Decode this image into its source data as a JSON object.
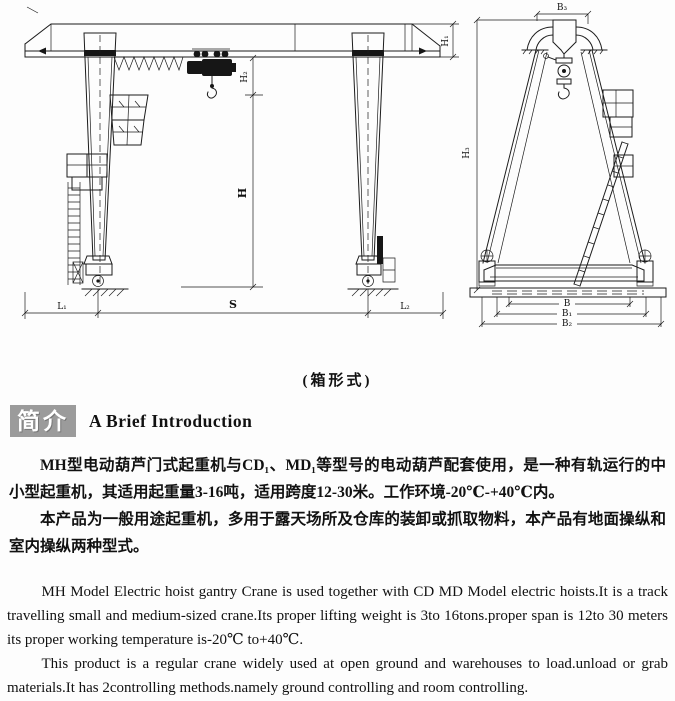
{
  "colors": {
    "line": "#1c1c1c",
    "badge_bg": "#9b9b9b",
    "text": "#111111"
  },
  "drawing": {
    "caption": "(箱形式)",
    "front_view": {
      "labels": {
        "h1": "H₁",
        "h2": "H₂",
        "h": "H",
        "s": "S",
        "l1": "L₁",
        "l2": "L₂"
      }
    },
    "side_view": {
      "labels": {
        "b3": "B₃",
        "h3": "H₃",
        "b": "B",
        "b1": "B₁",
        "b2": "B₂"
      }
    }
  },
  "intro": {
    "badge_zh": "简介",
    "heading_en": "A Brief Introduction",
    "zh_paragraphs": [
      "MH型电动葫芦门式起重机与CD₁、MD₁等型号的电动葫芦配套使用，是一种有轨运行的中小型起重机，其适用起重量3-16吨，适用跨度12-30米。工作环境-20℃-+40℃内。",
      "本产品为一般用途起重机，多用于露天场所及仓库的装卸或抓取物料，本产品有地面操纵和室内操纵两种型式。"
    ],
    "en_paragraphs": [
      "MH Model Electric hoist gantry Crane is used together with CD MD Model electric hoists.It is a track travelling small and medium-sized crane.Its proper lifting weight is 3to 16tons.proper span is 12to 30 meters its proper working temperature is-20℃ to+40℃.",
      "This product is a regular crane widely used at open ground and warehouses to load.unload or grab materials.It has 2controlling methods.namely ground controlling and room controlling."
    ]
  }
}
